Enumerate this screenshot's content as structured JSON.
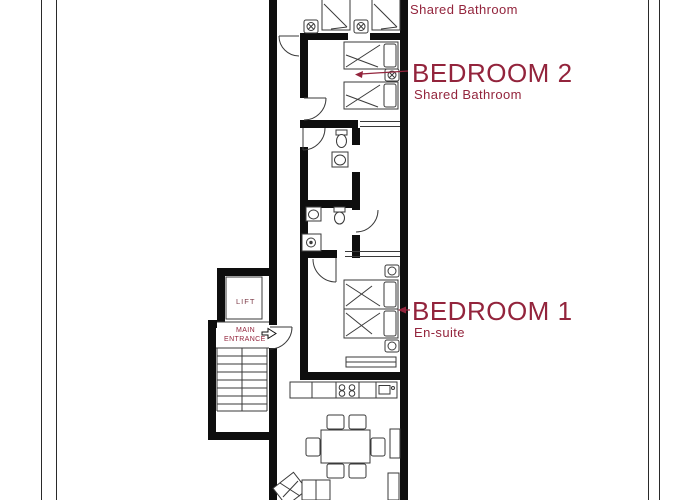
{
  "sheet_title": "Apartment floor plan",
  "colors": {
    "label_red": "#93243c",
    "wall_black": "#0e0e0e",
    "furniture_line": "#3a3a3a",
    "border_line": "#2a2a2a"
  },
  "labels": {
    "top_room_subtitle": "Shared Bathroom",
    "bedroom2": {
      "title": "BEDROOM 2",
      "subtitle": "Shared Bathroom"
    },
    "bedroom1": {
      "title": "BEDROOM 1",
      "subtitle": "En-suite"
    },
    "lift": "LIFT",
    "main_entrance_line1": "MAIN",
    "main_entrance_line2": "ENTRANCE"
  },
  "rooms": [
    {
      "name": "Top bedroom (partial)",
      "note": "Shared Bathroom"
    },
    {
      "name": "Bedroom 2",
      "note": "Shared Bathroom"
    },
    {
      "name": "Bathroom 1 (shared)"
    },
    {
      "name": "Bathroom 2 (en-suite)"
    },
    {
      "name": "Bedroom 1",
      "note": "En-suite"
    },
    {
      "name": "Kitchen / Living / Dining"
    },
    {
      "name": "Lift"
    },
    {
      "name": "Stairs"
    },
    {
      "name": "Main entrance"
    }
  ]
}
